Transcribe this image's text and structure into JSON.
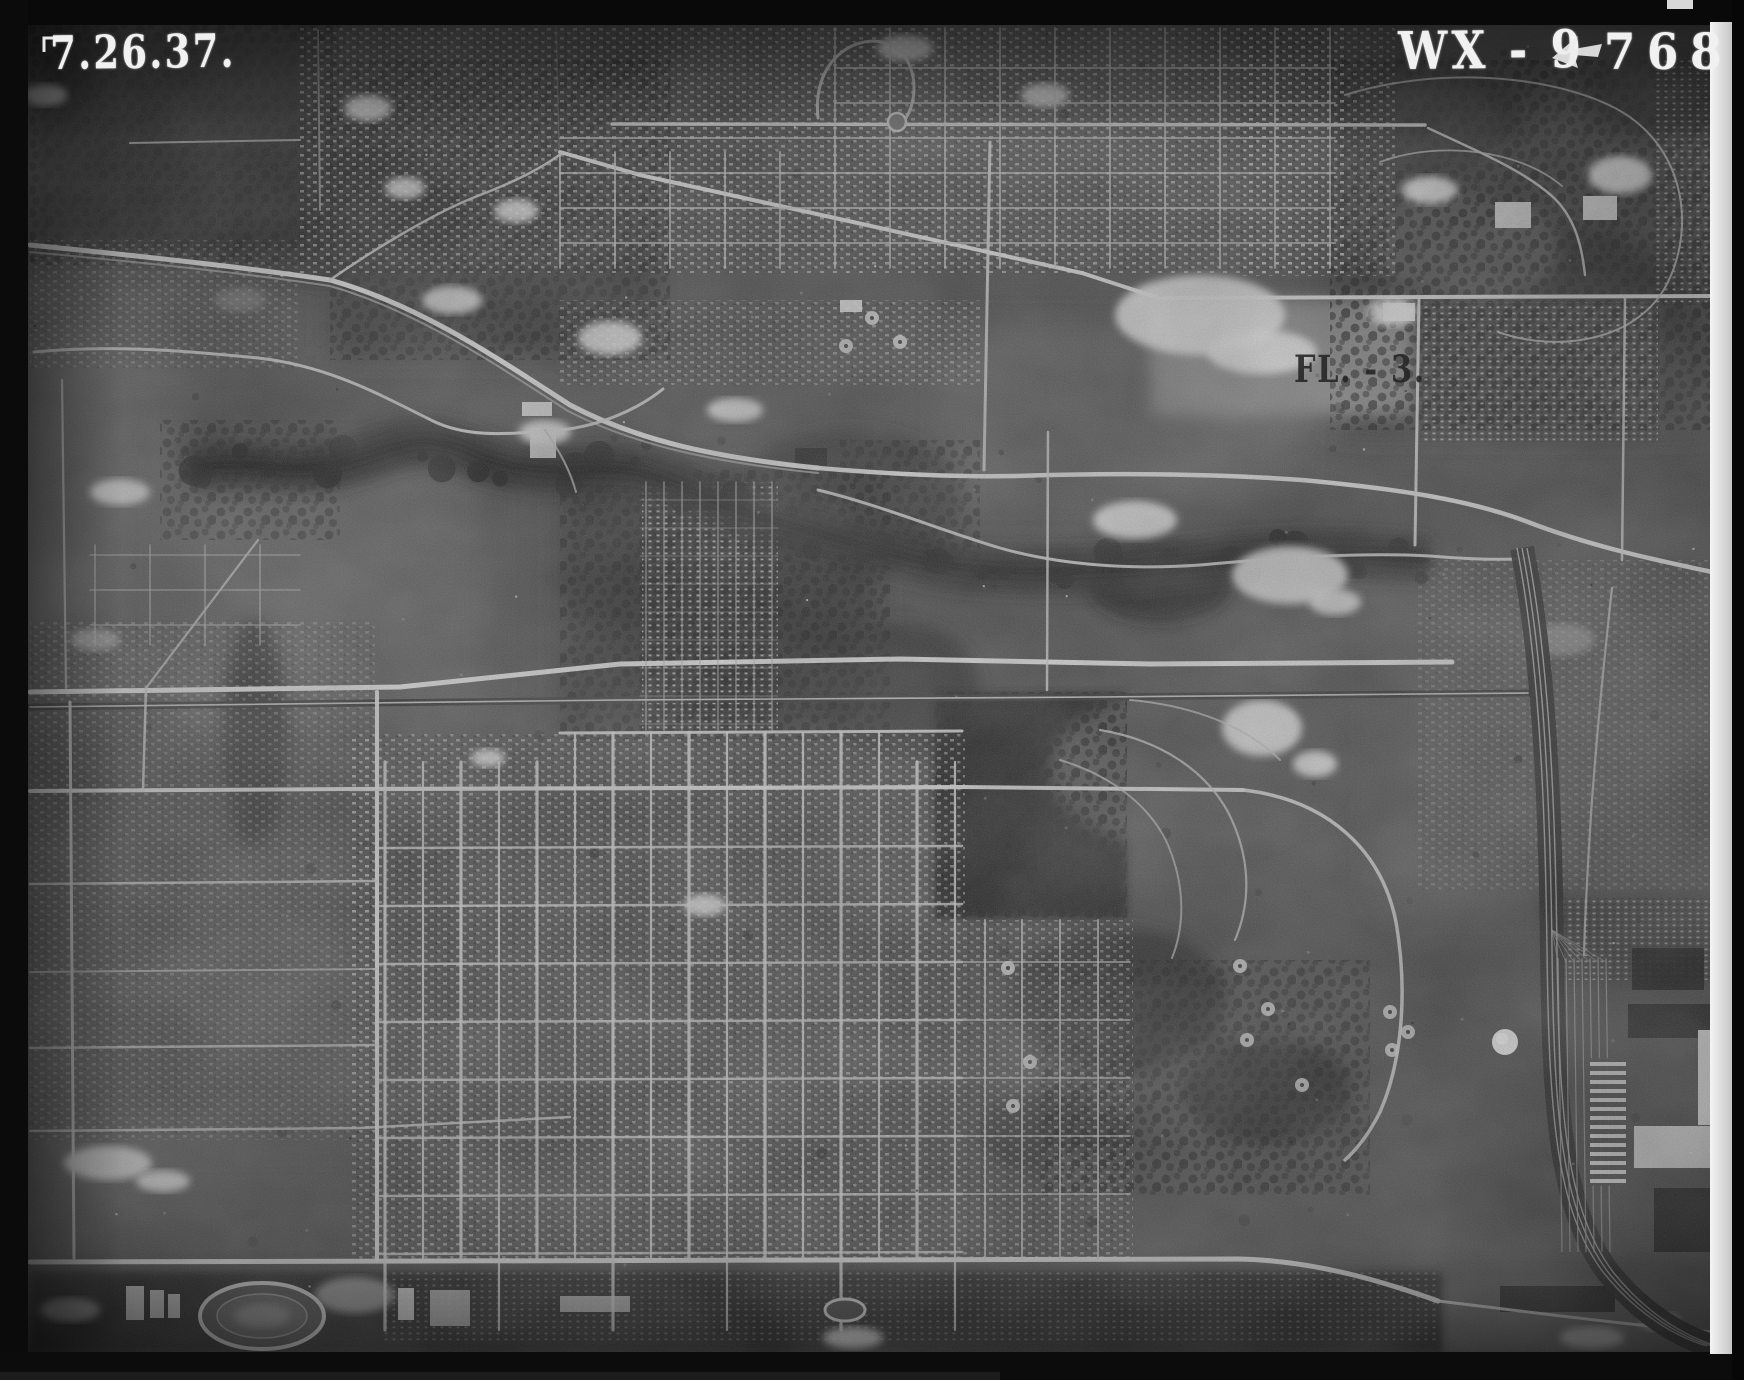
{
  "photo": {
    "date_stamp": "7.26.37.",
    "index_code": "WX - 9",
    "frame_number": "768",
    "ground_annotation": "FL. - 3."
  },
  "palette": {
    "film_border": "#0a0a0a",
    "photo_base": "#4a4a4a",
    "stamp_ink": "#f1f1f1",
    "annotation_ink": "#242424",
    "film_edge_strip": "#e8e8e8",
    "road_highlight": "#d8d8d8",
    "woods_dark": "#202020"
  }
}
